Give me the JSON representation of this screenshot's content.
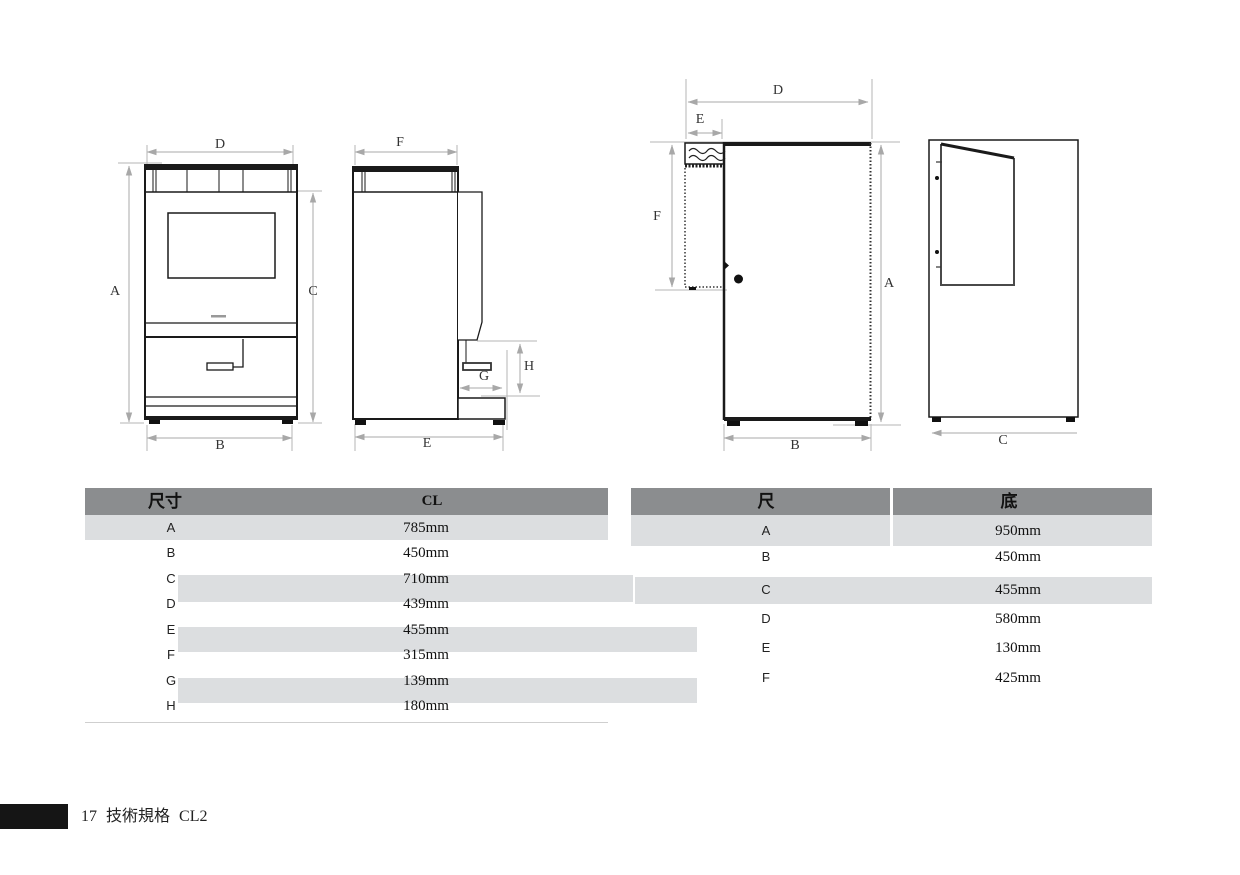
{
  "footer": {
    "page_number": "17",
    "section_title": "技術規格",
    "model": "CL2"
  },
  "drawings": {
    "front_view": {
      "dim_width_top": "D",
      "dim_height_left": "A",
      "dim_height_right": "C",
      "dim_width_bottom": "B"
    },
    "side_view": {
      "dim_depth_top": "F",
      "dim_spout_width": "G",
      "dim_spout_height": "H",
      "dim_depth_bottom": "E"
    },
    "door_front_view": {
      "dim_width_top": "D",
      "dim_tower_width": "E",
      "dim_tower_height": "F",
      "dim_height_right": "A",
      "dim_width_bottom": "B"
    },
    "door_side_view": {
      "dim_depth_bottom": "C"
    }
  },
  "tables": {
    "left": {
      "headers": [
        "尺寸",
        "CL"
      ],
      "rows": [
        {
          "label": "A",
          "value": "785mm"
        },
        {
          "label": "B",
          "value": "450mm"
        },
        {
          "label": "C",
          "value": "710mm"
        },
        {
          "label": "D",
          "value": "439mm"
        },
        {
          "label": "E",
          "value": "455mm"
        },
        {
          "label": "F",
          "value": "315mm"
        },
        {
          "label": "G",
          "value": "139mm"
        },
        {
          "label": "H",
          "value": "180mm"
        }
      ]
    },
    "right": {
      "headers": [
        "尺",
        "底"
      ],
      "rows": [
        {
          "label": "A",
          "value": "950mm"
        },
        {
          "label": "B",
          "value": "450mm"
        },
        {
          "label": "C",
          "value": "455mm"
        },
        {
          "label": "D",
          "value": "580mm"
        },
        {
          "label": "E",
          "value": "130mm"
        },
        {
          "label": "F",
          "value": "425mm"
        }
      ]
    }
  },
  "colors": {
    "table_header_bg": "#8b8d8f",
    "table_band_bg": "#dcdee0",
    "dimension_line": "#a8a8a8",
    "drawing_line": "#1a1a1a"
  }
}
